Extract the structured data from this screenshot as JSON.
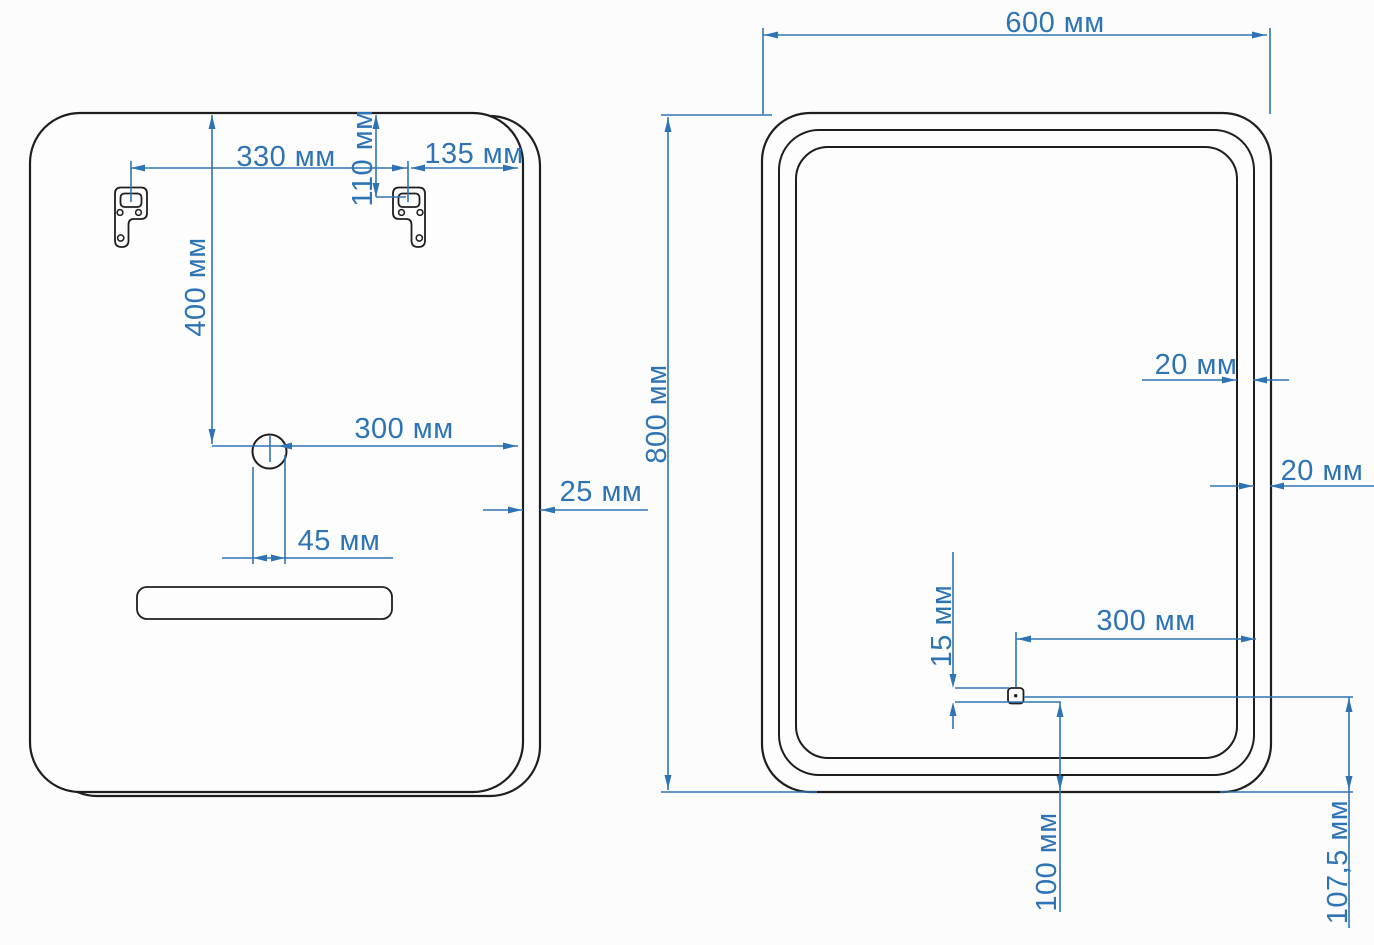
{
  "drawing": {
    "type": "mirror installation drawing",
    "unit": "мм",
    "colors": {
      "dimension": "#2e74b5",
      "outline": "#1e1e1e",
      "background": "#fcfcfc"
    },
    "back_view": {
      "title": "back view with mounting brackets",
      "dims": {
        "bracket_spacing": "330 мм",
        "bracket_top_offset": "110 мм",
        "bracket_right_offset": "135 мм",
        "hole_top_offset": "400 мм",
        "hole_right_offset": "300 мм",
        "hole_side_offset": "45 мм",
        "depth": "25 мм"
      }
    },
    "front_view": {
      "title": "front view with led frame and sensor",
      "dims": {
        "width": "600 мм",
        "height": "800 мм",
        "frame_gap_inner": "20 мм",
        "frame_gap_outer": "20 мм",
        "sensor_size": "15 мм",
        "sensor_right_offset": "300 мм",
        "sensor_bottom_offset": "100 мм",
        "sensor_bottom_total": "107,5 мм"
      }
    }
  }
}
